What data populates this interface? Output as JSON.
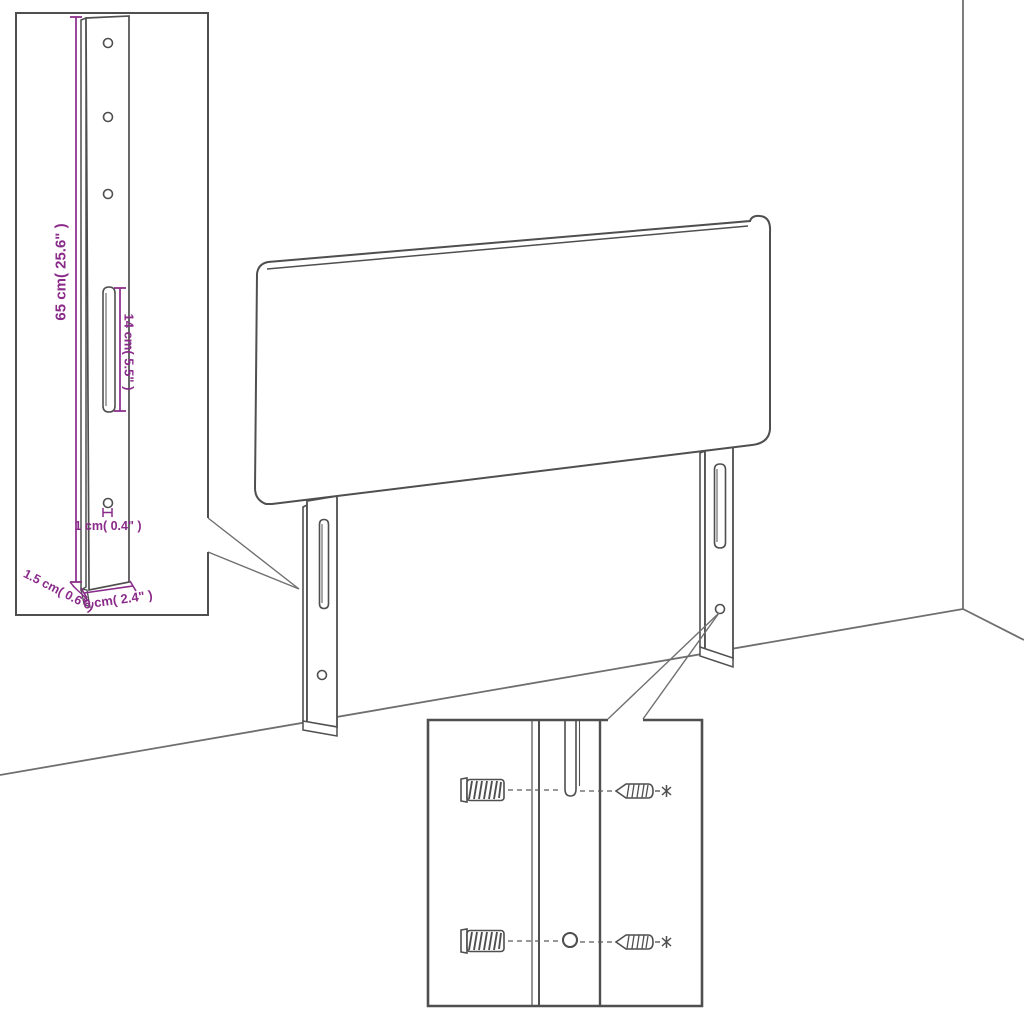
{
  "colors": {
    "line": "#4f4f4f",
    "wall_line": "#6f6f6f",
    "dimension": "#8a2b8a",
    "background": "#ffffff"
  },
  "bracket_detail": {
    "labels": {
      "height": "65 cm( 25.6\" )",
      "slot_length": "14 cm( 5.5\" )",
      "hole_width": "1 cm( 0.4\" )",
      "thickness": "1.5 cm( 0.6\" )",
      "width": "6 cm( 2.4\" )"
    },
    "holes": 4,
    "slots": 1
  },
  "mounting_detail": {
    "wall_plugs": 2,
    "screws": 2,
    "holes": 1,
    "slots": 1
  },
  "headboard": {
    "legs": 2,
    "slots_per_leg": 1,
    "holes_per_leg": 1
  }
}
